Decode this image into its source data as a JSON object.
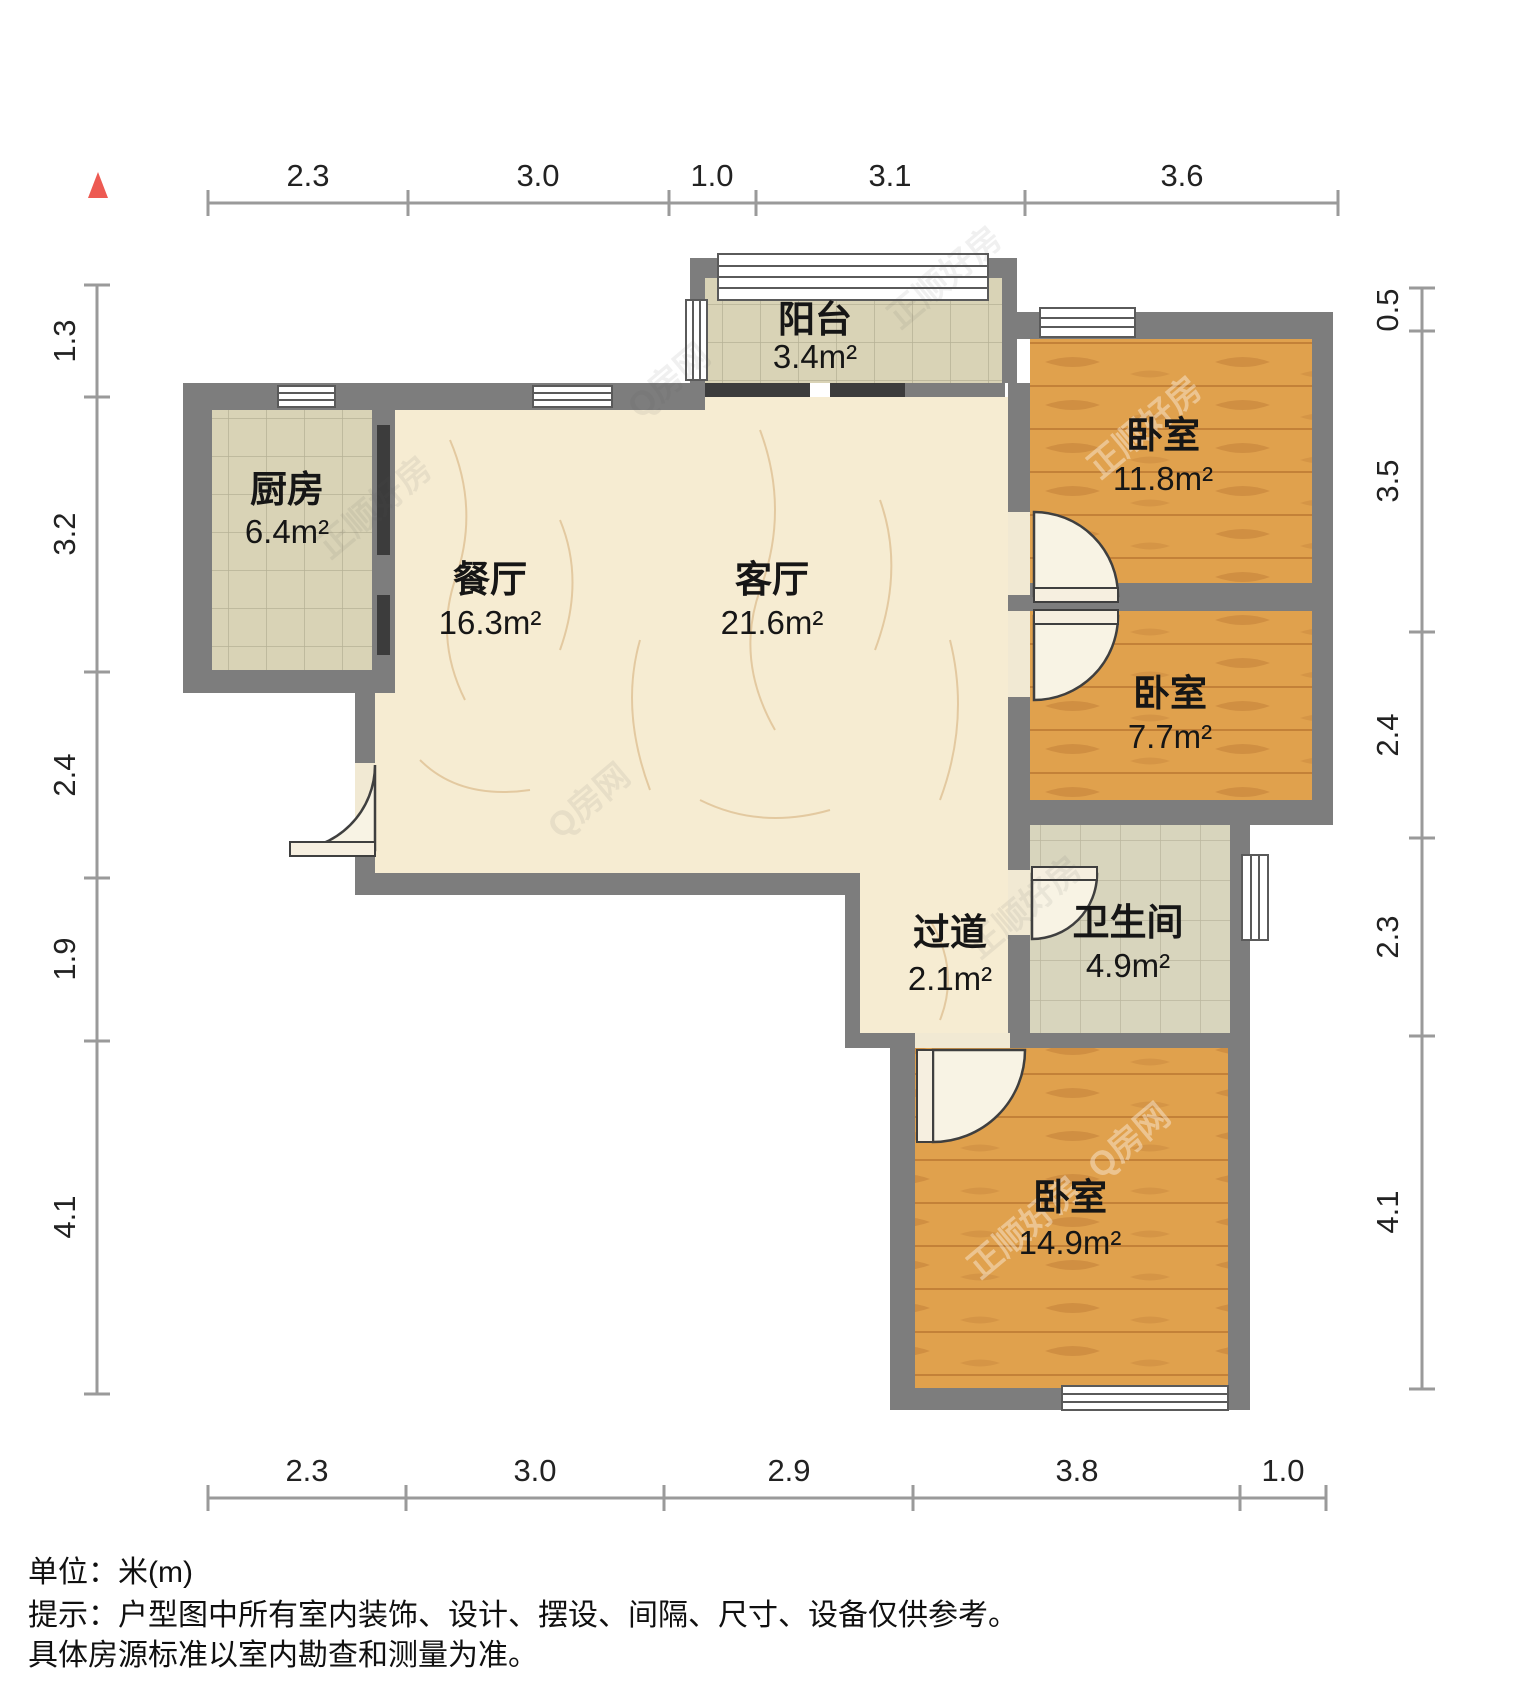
{
  "title": "户型图",
  "north_indicator": {
    "name": "north-arrow",
    "color": "#ed5a52"
  },
  "rooms": {
    "balcony": {
      "name": "阳台",
      "area": "3.4m²"
    },
    "kitchen": {
      "name": "厨房",
      "area": "6.4m²"
    },
    "dining": {
      "name": "餐厅",
      "area": "16.3m²"
    },
    "living": {
      "name": "客厅",
      "area": "21.6m²"
    },
    "bedroom_top": {
      "name": "卧室",
      "area": "11.8m²"
    },
    "bedroom_mid": {
      "name": "卧室",
      "area": "7.7m²"
    },
    "hallway": {
      "name": "过道",
      "area": "2.1m²"
    },
    "bathroom": {
      "name": "卫生间",
      "area": "4.9m²"
    },
    "bedroom_bottom": {
      "name": "卧室",
      "area": "14.9m²"
    }
  },
  "dims": {
    "top": [
      "2.3",
      "3.0",
      "1.0",
      "3.1",
      "3.6"
    ],
    "left": [
      "1.3",
      "3.2",
      "2.4",
      "1.9",
      "4.1"
    ],
    "right": [
      "0.5",
      "3.5",
      "2.4",
      "2.3",
      "4.1"
    ],
    "bottom": [
      "2.3",
      "3.0",
      "2.9",
      "3.8",
      "1.0"
    ]
  },
  "footer": {
    "unit": "单位：米(m)",
    "tip1": "提示：户型图中所有室内装饰、设计、摆设、间隔、尺寸、设备仅供参考。",
    "tip2": "具体房源标准以室内勘查和测量为准。"
  },
  "watermark": {
    "brand": "正顺好房",
    "site": "Q房网"
  },
  "colors": {
    "wall": "#7d7d7d",
    "wood_floor": "#e0a14d",
    "tile_floor": "#d9d3b6",
    "marble_floor": "#f6ecd2",
    "north_arrow": "#ed5a52",
    "dim_line": "#9a9a9a"
  }
}
